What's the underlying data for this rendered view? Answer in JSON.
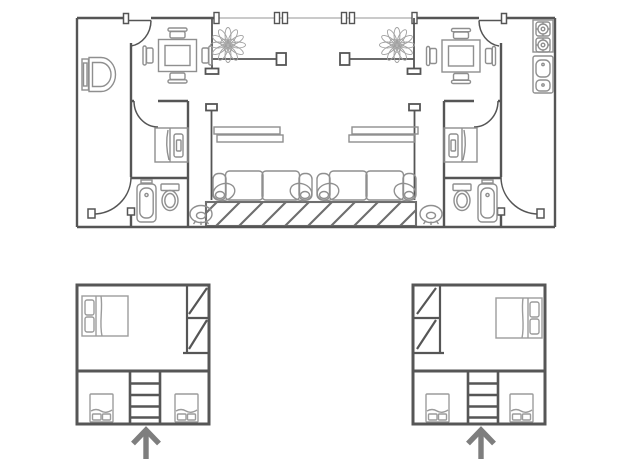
{
  "colors": {
    "background": "#ffffff",
    "wall": "#555555",
    "wall_lower": "#565656",
    "furniture": "#8f8f8f",
    "furniture_light": "#9c9c9c",
    "rug": "#6e6e6e",
    "window": "#b8b8b8",
    "plant": "#a0a0a0",
    "arrow": "#7e7e7e"
  },
  "main_plan": {
    "fixtures": [
      "wall-hung-toilet",
      "dining-table-with-four-chairs",
      "potted-plant",
      "glass-partition",
      "wall-shelf",
      "two-seat-sofa",
      "hatched-rug",
      "round-pouf",
      "single-bed",
      "bathtub",
      "toilet",
      "stove-two-burners",
      "double-sink",
      "door-swing"
    ]
  },
  "lower_plan_left": {
    "fixtures": [
      "double-bed",
      "wardrobe-two-cells",
      "staircase",
      "single-bed",
      "single-bed"
    ],
    "arrow_direction": "up"
  },
  "lower_plan_right": {
    "fixtures": [
      "wardrobe-two-cells",
      "double-bed",
      "staircase",
      "single-bed",
      "single-bed"
    ],
    "arrow_direction": "up"
  }
}
